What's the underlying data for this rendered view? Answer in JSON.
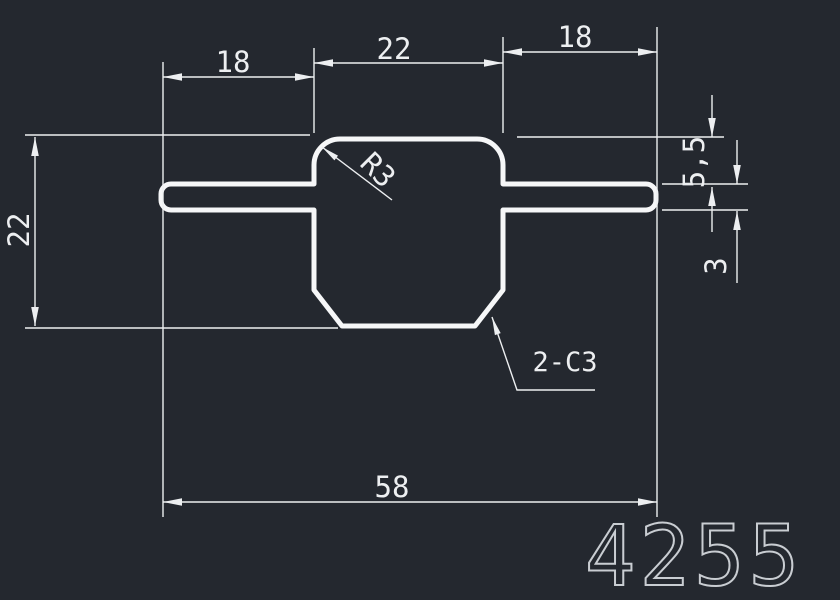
{
  "canvas": {
    "width": 840,
    "height": 600,
    "background_color": "#24282f",
    "profile_line_color": "#f6f7f8",
    "dimension_color": "#edeff1",
    "drawing_number_color": "#c9cdd2"
  },
  "drawing": {
    "dimensions": {
      "top_left_fin_width": "18",
      "top_center_width": "22",
      "top_right_fin_width": "18",
      "left_total_height": "22",
      "right_top_offset": "5,5",
      "right_fin_thickness": "3",
      "bottom_total_width": "58"
    },
    "annotations": {
      "fillet_radius": "R3",
      "chamfer": "2-C3"
    },
    "drawing_number": "4255"
  }
}
